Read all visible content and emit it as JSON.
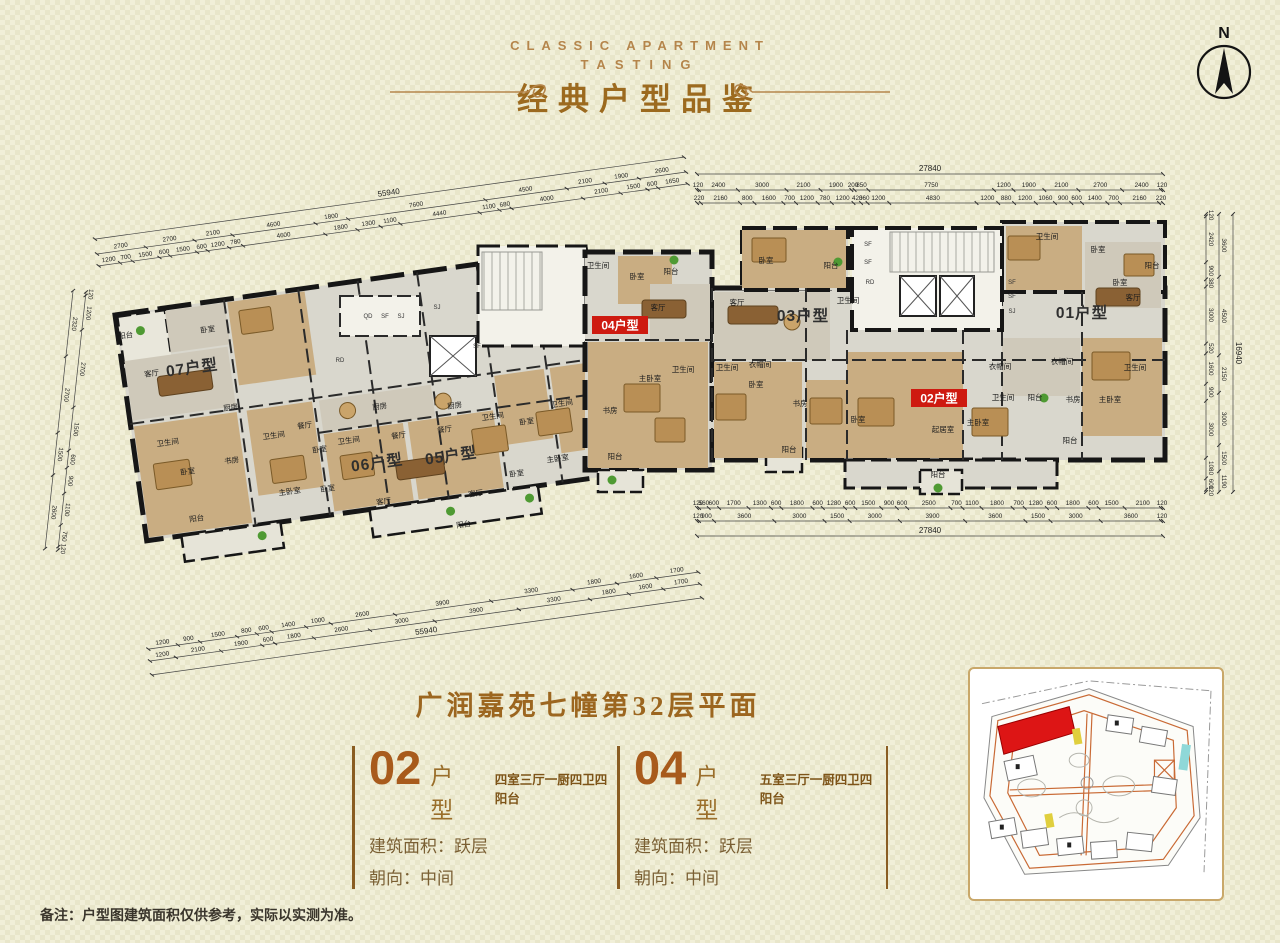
{
  "header": {
    "line1": "CLASSIC APARTMENT",
    "line2": "TASTING",
    "title": "经典户型品鉴"
  },
  "compass": {
    "label": "N"
  },
  "colors": {
    "accent_gold": "#b5854b",
    "title_brown": "#9c661f",
    "number_orange": "#a85b1c",
    "highlight_red": "#ce1a10",
    "siteplan_red": "#dd1515"
  },
  "plan": {
    "unit_highlight_color": "#ce1a10",
    "units": [
      {
        "label": "07户型",
        "highlight": false,
        "x": 192,
        "y": 368,
        "r": -8
      },
      {
        "label": "06户型",
        "highlight": false,
        "x": 377,
        "y": 463,
        "r": -8
      },
      {
        "label": "05户型",
        "highlight": false,
        "x": 451,
        "y": 456,
        "r": -8
      },
      {
        "label": "04户型",
        "highlight": true,
        "x": 620,
        "y": 325,
        "r": 0
      },
      {
        "label": "03户型",
        "highlight": false,
        "x": 803,
        "y": 316,
        "r": 0
      },
      {
        "label": "02户型",
        "highlight": true,
        "x": 939,
        "y": 398,
        "r": 0
      },
      {
        "label": "01户型",
        "highlight": false,
        "x": 1082,
        "y": 313,
        "r": 0
      }
    ],
    "room_labels": [
      {
        "t": "阳台",
        "x": 126,
        "y": 338,
        "r": -8
      },
      {
        "t": "卧室",
        "x": 208,
        "y": 332,
        "r": -8
      },
      {
        "t": "客厅",
        "x": 152,
        "y": 376,
        "r": -8
      },
      {
        "t": "卫生间",
        "x": 168,
        "y": 445,
        "r": -8
      },
      {
        "t": "卧室",
        "x": 188,
        "y": 474,
        "r": -8
      },
      {
        "t": "书房",
        "x": 232,
        "y": 463,
        "r": -8
      },
      {
        "t": "主卧室",
        "x": 290,
        "y": 494,
        "r": -8
      },
      {
        "t": "卫生间",
        "x": 274,
        "y": 438,
        "r": -8
      },
      {
        "t": "餐厅",
        "x": 305,
        "y": 428,
        "r": -8
      },
      {
        "t": "厨房",
        "x": 231,
        "y": 410,
        "r": -8
      },
      {
        "t": "卧室",
        "x": 320,
        "y": 452,
        "r": -8
      },
      {
        "t": "卧室",
        "x": 328,
        "y": 491,
        "r": -8
      },
      {
        "t": "阳台",
        "x": 197,
        "y": 521,
        "r": -8
      },
      {
        "t": "厨房",
        "x": 380,
        "y": 409,
        "r": -8
      },
      {
        "t": "餐厅",
        "x": 399,
        "y": 438,
        "r": -8
      },
      {
        "t": "卫生间",
        "x": 349,
        "y": 443,
        "r": -8
      },
      {
        "t": "客厅",
        "x": 384,
        "y": 504,
        "r": -8
      },
      {
        "t": "阳台",
        "x": 464,
        "y": 527,
        "r": -8
      },
      {
        "t": "厨房",
        "x": 455,
        "y": 408,
        "r": -8
      },
      {
        "t": "餐厅",
        "x": 445,
        "y": 432,
        "r": -8
      },
      {
        "t": "卫生间",
        "x": 493,
        "y": 419,
        "r": -8
      },
      {
        "t": "卧室",
        "x": 527,
        "y": 424,
        "r": -8
      },
      {
        "t": "卫生间",
        "x": 562,
        "y": 406,
        "r": -8
      },
      {
        "t": "客厅",
        "x": 476,
        "y": 496,
        "r": -8
      },
      {
        "t": "卧室",
        "x": 517,
        "y": 476,
        "r": -8
      },
      {
        "t": "主卧室",
        "x": 558,
        "y": 461,
        "r": -8
      },
      {
        "t": "书房",
        "x": 610,
        "y": 413,
        "r": 0
      },
      {
        "t": "阳台",
        "x": 615,
        "y": 459,
        "r": 0
      },
      {
        "t": "卫生间",
        "x": 598,
        "y": 268,
        "r": 0
      },
      {
        "t": "卧室",
        "x": 637,
        "y": 279,
        "r": 0
      },
      {
        "t": "阳台",
        "x": 671,
        "y": 274,
        "r": 0
      },
      {
        "t": "客厅",
        "x": 658,
        "y": 310,
        "r": 0
      },
      {
        "t": "主卧室",
        "x": 650,
        "y": 381,
        "r": 0
      },
      {
        "t": "卫生间",
        "x": 683,
        "y": 372,
        "r": 0
      },
      {
        "t": "卧室",
        "x": 766,
        "y": 263,
        "r": 0
      },
      {
        "t": "阳台",
        "x": 831,
        "y": 268,
        "r": 0
      },
      {
        "t": "客厅",
        "x": 737,
        "y": 305,
        "r": 0
      },
      {
        "t": "卫生间",
        "x": 848,
        "y": 303,
        "r": 0
      },
      {
        "t": "卫生间",
        "x": 727,
        "y": 370,
        "r": 0
      },
      {
        "t": "衣帽间",
        "x": 760,
        "y": 367,
        "r": 0
      },
      {
        "t": "卧室",
        "x": 756,
        "y": 387,
        "r": 0
      },
      {
        "t": "书房",
        "x": 800,
        "y": 406,
        "r": 0
      },
      {
        "t": "阳台",
        "x": 789,
        "y": 452,
        "r": 0
      },
      {
        "t": "卧室",
        "x": 858,
        "y": 422,
        "r": 0
      },
      {
        "t": "起居室",
        "x": 943,
        "y": 432,
        "r": 0
      },
      {
        "t": "主卧室",
        "x": 978,
        "y": 425,
        "r": 0
      },
      {
        "t": "阳台",
        "x": 938,
        "y": 477,
        "r": 0
      },
      {
        "t": "卫生间",
        "x": 1003,
        "y": 400,
        "r": 0
      },
      {
        "t": "阳台",
        "x": 1035,
        "y": 400,
        "r": 0
      },
      {
        "t": "书房",
        "x": 1073,
        "y": 402,
        "r": 0
      },
      {
        "t": "阳台",
        "x": 1070,
        "y": 443,
        "r": 0
      },
      {
        "t": "衣帽间",
        "x": 1000,
        "y": 369,
        "r": 0
      },
      {
        "t": "衣帽间",
        "x": 1062,
        "y": 364,
        "r": 0
      },
      {
        "t": "卫生间",
        "x": 1135,
        "y": 370,
        "r": 0
      },
      {
        "t": "主卧室",
        "x": 1110,
        "y": 402,
        "r": 0
      },
      {
        "t": "客厅",
        "x": 1133,
        "y": 300,
        "r": 0
      },
      {
        "t": "卧室",
        "x": 1120,
        "y": 285,
        "r": 0
      },
      {
        "t": "卫生间",
        "x": 1047,
        "y": 239,
        "r": 0
      },
      {
        "t": "卧室",
        "x": 1098,
        "y": 252,
        "r": 0
      },
      {
        "t": "阳台",
        "x": 1152,
        "y": 268,
        "r": 0
      }
    ],
    "core_labels": [
      {
        "t": "QD",
        "x": 368,
        "y": 318
      },
      {
        "t": "SF",
        "x": 385,
        "y": 318
      },
      {
        "t": "SJ",
        "x": 401,
        "y": 318
      },
      {
        "t": "RD",
        "x": 340,
        "y": 362
      },
      {
        "t": "SF",
        "x": 868,
        "y": 246
      },
      {
        "t": "SF",
        "x": 868,
        "y": 264
      },
      {
        "t": "RD",
        "x": 870,
        "y": 284
      },
      {
        "t": "SF",
        "x": 1012,
        "y": 284
      },
      {
        "t": "SF",
        "x": 1012,
        "y": 298
      },
      {
        "t": "SJ",
        "x": 1012,
        "y": 313
      },
      {
        "t": "SF",
        "x": 477,
        "y": 348
      },
      {
        "t": "SJ",
        "x": 437,
        "y": 309
      }
    ],
    "dims": [
      {
        "name": "dim-right-top",
        "p1": [
          697,
          190
        ],
        "p2": [
          1163,
          190
        ],
        "rows": [
          {
            "o": -16,
            "vals": [
              "27840"
            ]
          },
          {
            "o": 0,
            "vals": [
              "120",
              "2400",
              "3000",
              "2100",
              "1900",
              "200",
              "850",
              "7750",
              "1200",
              "1900",
              "2100",
              "2700",
              "2400",
              "120"
            ]
          },
          {
            "o": 13,
            "vals": [
              "220",
              "2160",
              "800",
              "1600",
              "700",
              "1200",
              "780",
              "1200",
              "420",
              "360",
              "1200",
              "4830",
              "1200",
              "880",
              "1200",
              "1060",
              "900",
              "600",
              "1400",
              "700",
              "2160",
              "220"
            ]
          }
        ]
      },
      {
        "name": "dim-right-bottom",
        "p1": [
          697,
          508
        ],
        "p2": [
          1163,
          508
        ],
        "rows": [
          {
            "o": 0,
            "vals": [
              "120",
              "560",
              "600",
              "1700",
              "1300",
              "600",
              "1800",
              "600",
              "1280",
              "600",
              "1500",
              "900",
              "600",
              "2500",
              "700",
              "1100",
              "1800",
              "700",
              "1280",
              "600",
              "1800",
              "600",
              "1500",
              "2100",
              "120"
            ]
          },
          {
            "o": 13,
            "vals": [
              "120",
              "900",
              "3600",
              "3000",
              "1500",
              "3000",
              "3900",
              "3600",
              "1500",
              "3000",
              "3600",
              "120"
            ]
          },
          {
            "o": 28,
            "vals": [
              "27840"
            ]
          }
        ]
      },
      {
        "name": "dim-left-top",
        "p1": [
          97,
          254
        ],
        "p2": [
          686,
          172
        ],
        "rows": [
          {
            "o": -15,
            "vals": [
              "55940"
            ]
          },
          {
            "o": 0,
            "vals": [
              "2700",
              "2700",
              "2100",
              "4600",
              "1800",
              "7600",
              "4500",
              "2100",
              "1900",
              "2600"
            ]
          },
          {
            "o": 12,
            "vals": [
              "1200",
              "700",
              "1500",
              "600",
              "1500",
              "600",
              "1200",
              "780",
              "4600",
              "1800",
              "1300",
              "1100",
              "4440",
              "1100",
              "680",
              "4000",
              "2100",
              "1500",
              "600",
              "1650"
            ]
          }
        ]
      },
      {
        "name": "dim-left-bottom",
        "p1": [
          150,
          661
        ],
        "p2": [
          700,
          584
        ],
        "rows": [
          {
            "o": -12,
            "vals": [
              "1200",
              "900",
              "1500",
              "800",
              "600",
              "1400",
              "1000",
              "2600",
              "3900",
              "3300",
              "1800",
              "1600",
              "1700"
            ]
          },
          {
            "o": 0,
            "vals": [
              "1200",
              "2100",
              "1900",
              "600",
              "1800",
              "2600",
              "3000",
              "3900",
              "3300",
              "1800",
              "1600",
              "1700"
            ]
          },
          {
            "o": 14,
            "vals": [
              "55940"
            ]
          }
        ]
      },
      {
        "name": "dim-right-side",
        "p1": [
          1206,
          214
        ],
        "p2": [
          1206,
          492
        ],
        "rows": [
          {
            "o": 0,
            "vals": [
              "120",
              "2420",
              "900",
              "380",
              "3000",
              "520",
              "1600",
              "900",
              "3000",
              "1080",
              "600",
              "120"
            ]
          },
          {
            "o": -13,
            "vals": [
              "3600",
              "4500",
              "2150",
              "3000",
              "1500",
              "1190"
            ]
          },
          {
            "o": -27,
            "vals": [
              "16940"
            ]
          }
        ]
      },
      {
        "name": "dim-left-side",
        "p1": [
          86,
          292
        ],
        "p2": [
          58,
          550
        ],
        "rows": [
          {
            "o": 0,
            "vals": [
              "120",
              "1200",
              "2700",
              "1500",
              "600",
              "900",
              "1100",
              "750",
              "120"
            ]
          },
          {
            "o": 13,
            "vals": [
              "2320",
              "2700",
              "1500",
              "2600"
            ]
          }
        ]
      }
    ]
  },
  "plan_title": "广润嘉苑七幢第32层平面",
  "units_info": [
    {
      "number": "02",
      "type_label": "户 型",
      "desc": "四室三厅一厨四卫四阳台",
      "area": "建筑面积：跃层",
      "facing": "朝向：中间"
    },
    {
      "number": "04",
      "type_label": "户 型",
      "desc": "五室三厅一厨四卫四阳台",
      "area": "建筑面积：跃层",
      "facing": "朝向：中间"
    }
  ],
  "note": "备注：户型图建筑面积仅供参考，实际以实测为准。"
}
